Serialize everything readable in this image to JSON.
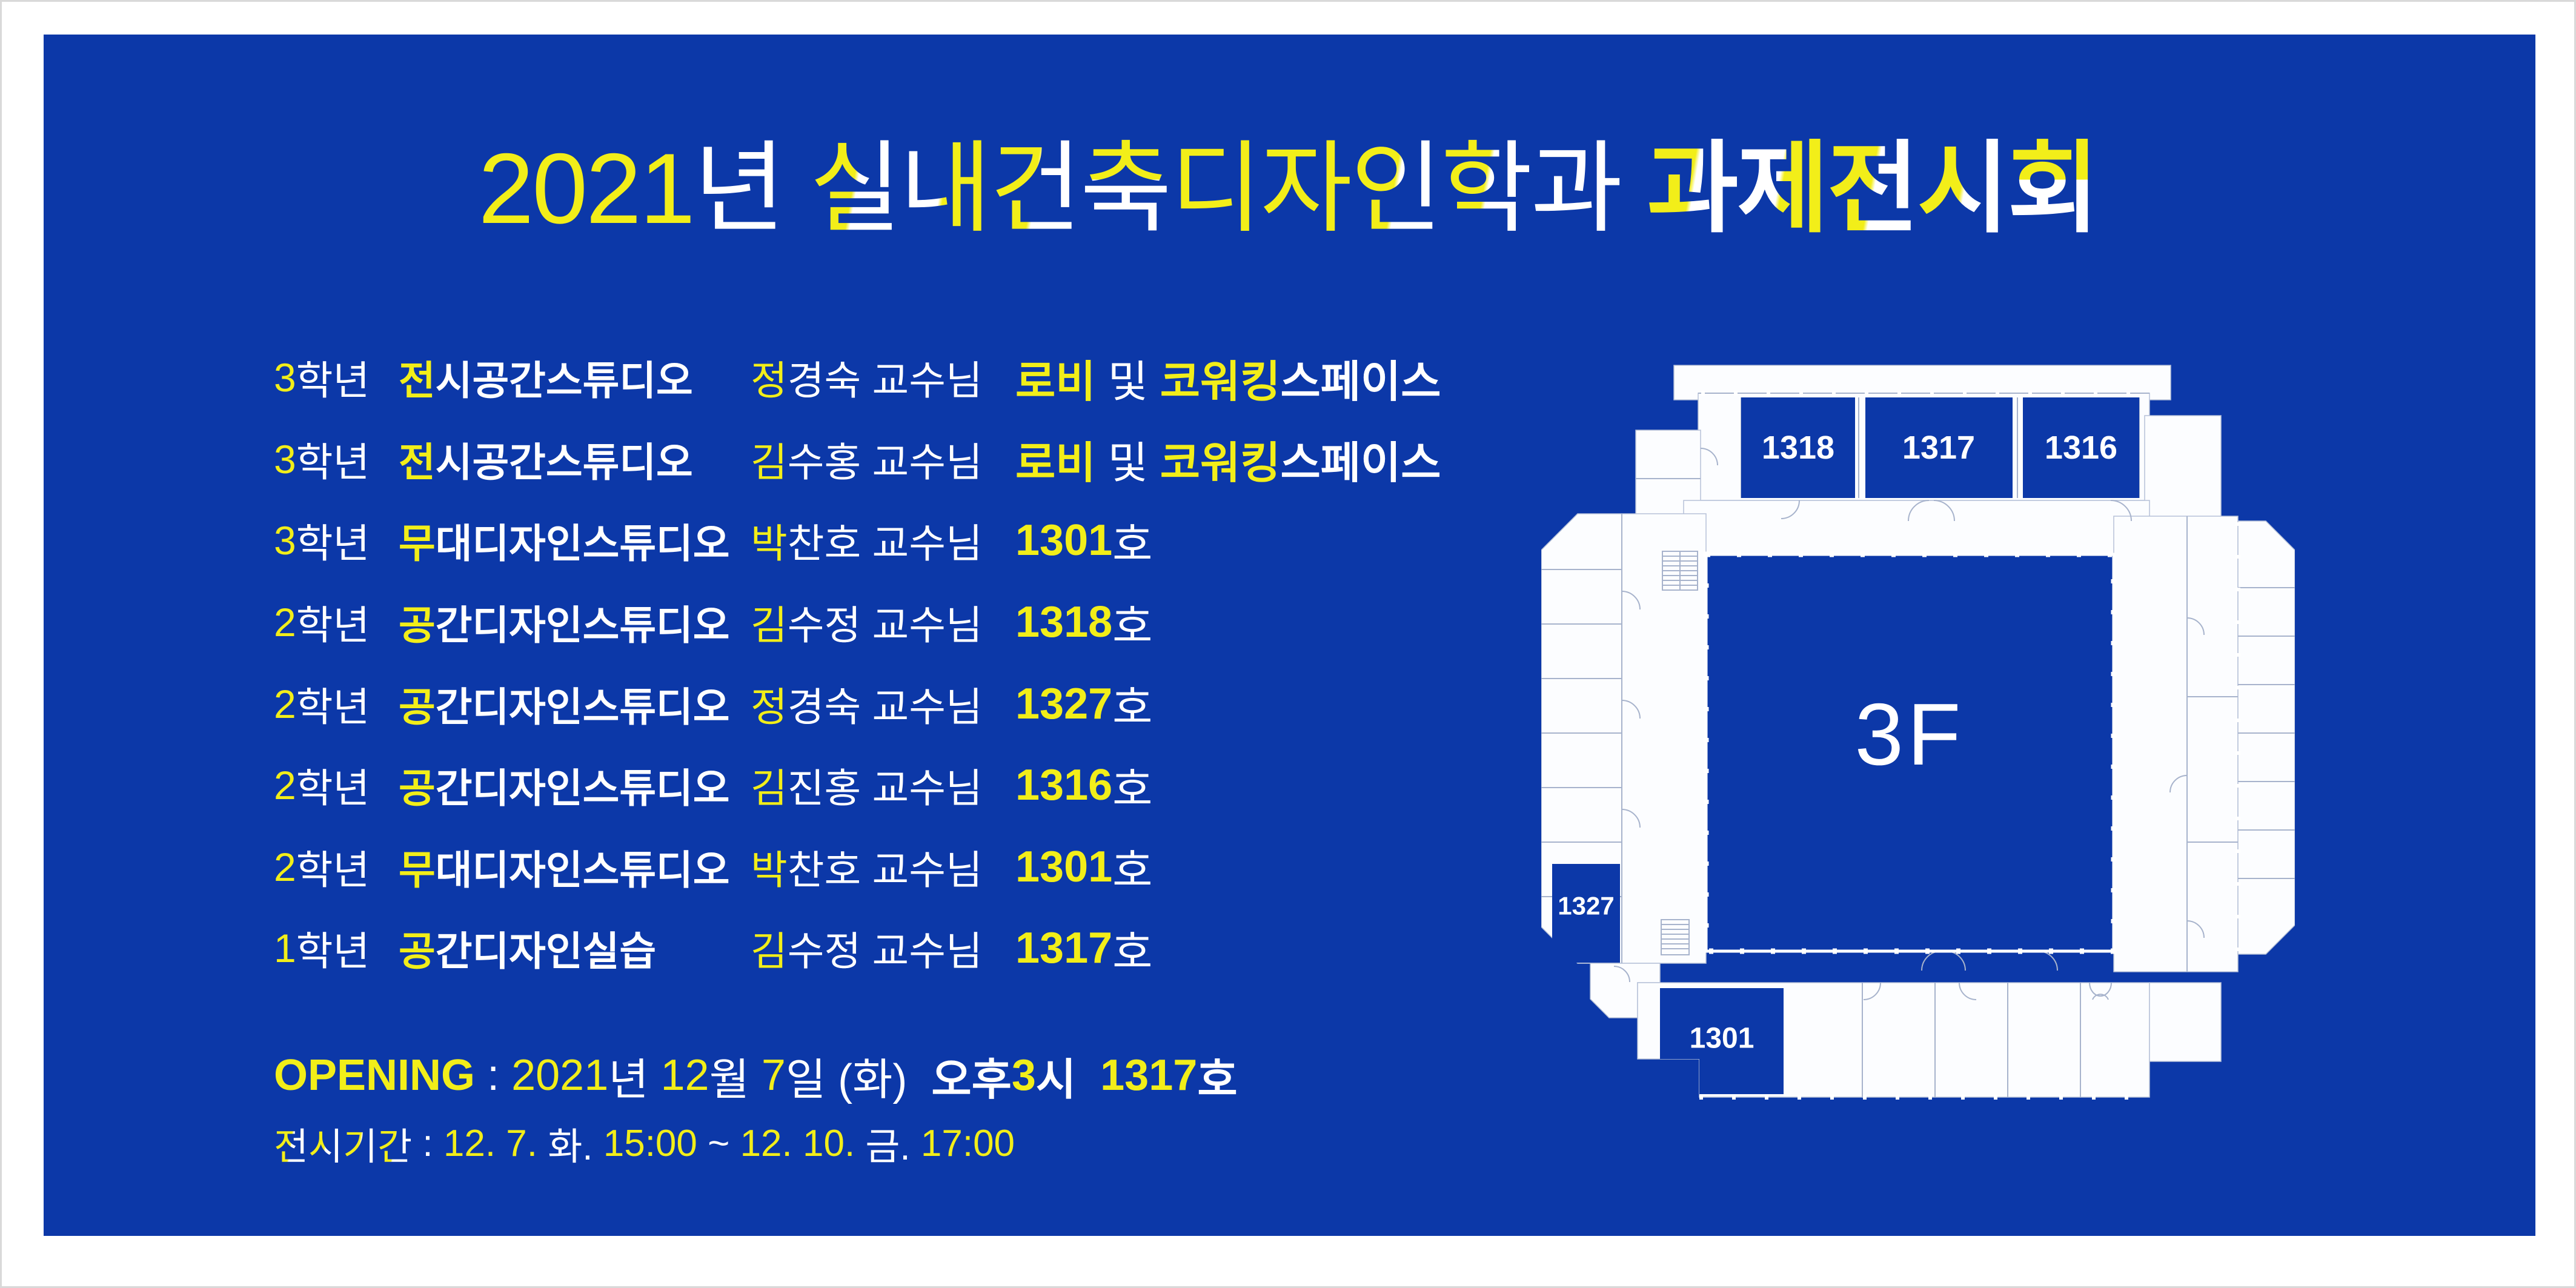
{
  "poster": {
    "colors": {
      "panel_blue": "#0C38A8",
      "accent_yellow": "#F2EE19",
      "text_white": "#FFFFFF",
      "plan_line": "#A7B3CC"
    },
    "title": {
      "segments": [
        {
          "t": "2021",
          "c": "y"
        },
        {
          "t": "년",
          "c": "w"
        },
        {
          "t": " ",
          "c": "w"
        },
        {
          "t": "실",
          "c": "yw"
        },
        {
          "t": "내",
          "c": "wy"
        },
        {
          "t": "건",
          "c": "yw"
        },
        {
          "t": "축",
          "c": "tb"
        },
        {
          "t": "디",
          "c": "y"
        },
        {
          "t": "자",
          "c": "y"
        },
        {
          "t": "인",
          "c": "yw"
        },
        {
          "t": "학",
          "c": "yw"
        },
        {
          "t": "과",
          "c": "w"
        },
        {
          "t": " ",
          "c": "w"
        },
        {
          "t": "과",
          "c": "yw",
          "b": true
        },
        {
          "t": "제",
          "c": "wy",
          "b": true
        },
        {
          "t": "전",
          "c": "yw",
          "b": true
        },
        {
          "t": "시",
          "c": "yw",
          "b": true
        },
        {
          "t": "회",
          "c": "tb",
          "b": true
        }
      ]
    },
    "schedule": {
      "rows": [
        {
          "grade": [
            {
              "t": "3",
              "c": "y"
            },
            {
              "t": "학년",
              "c": "w"
            }
          ],
          "studio": [
            {
              "t": "전",
              "c": "y",
              "b": true
            },
            {
              "t": "시공간스튜디오",
              "c": "w",
              "b": true
            }
          ],
          "professor": [
            {
              "t": "정",
              "c": "y"
            },
            {
              "t": "경숙 교수님",
              "c": "w"
            }
          ],
          "location": [
            {
              "t": "로비",
              "c": "y",
              "b": true
            },
            {
              "t": " 및 ",
              "c": "w"
            },
            {
              "t": "코워킹",
              "c": "y",
              "b": true
            },
            {
              "t": "스페이스",
              "c": "w",
              "b": true
            }
          ]
        },
        {
          "grade": [
            {
              "t": "3",
              "c": "y"
            },
            {
              "t": "학년",
              "c": "w"
            }
          ],
          "studio": [
            {
              "t": "전",
              "c": "y",
              "b": true
            },
            {
              "t": "시공간스튜디오",
              "c": "w",
              "b": true
            }
          ],
          "professor": [
            {
              "t": "김",
              "c": "y"
            },
            {
              "t": "수홍 교수님",
              "c": "w"
            }
          ],
          "location": [
            {
              "t": "로비",
              "c": "y",
              "b": true
            },
            {
              "t": " 및 ",
              "c": "w"
            },
            {
              "t": "코워킹",
              "c": "y",
              "b": true
            },
            {
              "t": "스페이스",
              "c": "w",
              "b": true
            }
          ]
        },
        {
          "grade": [
            {
              "t": "3",
              "c": "y"
            },
            {
              "t": "학년",
              "c": "w"
            }
          ],
          "studio": [
            {
              "t": "무",
              "c": "y",
              "b": true
            },
            {
              "t": "대디자인스튜디오",
              "c": "w",
              "b": true
            }
          ],
          "professor": [
            {
              "t": "박",
              "c": "y"
            },
            {
              "t": "찬호 교수님",
              "c": "w"
            }
          ],
          "location": [
            {
              "t": "1301",
              "c": "y",
              "b": true
            },
            {
              "t": "호",
              "c": "w"
            }
          ]
        },
        {
          "grade": [
            {
              "t": "2",
              "c": "y"
            },
            {
              "t": "학년",
              "c": "w"
            }
          ],
          "studio": [
            {
              "t": "공",
              "c": "y",
              "b": true
            },
            {
              "t": "간디자인스튜디오",
              "c": "w",
              "b": true
            }
          ],
          "professor": [
            {
              "t": "김",
              "c": "y"
            },
            {
              "t": "수정 교수님",
              "c": "w"
            }
          ],
          "location": [
            {
              "t": "1318",
              "c": "y",
              "b": true
            },
            {
              "t": "호",
              "c": "w"
            }
          ]
        },
        {
          "grade": [
            {
              "t": "2",
              "c": "y"
            },
            {
              "t": "학년",
              "c": "w"
            }
          ],
          "studio": [
            {
              "t": "공",
              "c": "y",
              "b": true
            },
            {
              "t": "간디자인스튜디오",
              "c": "w",
              "b": true
            }
          ],
          "professor": [
            {
              "t": "정",
              "c": "y"
            },
            {
              "t": "경숙 교수님",
              "c": "w"
            }
          ],
          "location": [
            {
              "t": "1327",
              "c": "y",
              "b": true
            },
            {
              "t": "호",
              "c": "w"
            }
          ]
        },
        {
          "grade": [
            {
              "t": "2",
              "c": "y"
            },
            {
              "t": "학년",
              "c": "w"
            }
          ],
          "studio": [
            {
              "t": "공",
              "c": "y",
              "b": true
            },
            {
              "t": "간디자인스튜디오",
              "c": "w",
              "b": true
            }
          ],
          "professor": [
            {
              "t": "김",
              "c": "y"
            },
            {
              "t": "진홍 교수님",
              "c": "w"
            }
          ],
          "location": [
            {
              "t": "1316",
              "c": "y",
              "b": true
            },
            {
              "t": "호",
              "c": "w"
            }
          ]
        },
        {
          "grade": [
            {
              "t": "2",
              "c": "y"
            },
            {
              "t": "학년",
              "c": "w"
            }
          ],
          "studio": [
            {
              "t": "무",
              "c": "y",
              "b": true
            },
            {
              "t": "대디자인스튜디오",
              "c": "w",
              "b": true
            }
          ],
          "professor": [
            {
              "t": "박",
              "c": "y"
            },
            {
              "t": "찬호 교수님",
              "c": "w"
            }
          ],
          "location": [
            {
              "t": "1301",
              "c": "y",
              "b": true
            },
            {
              "t": "호",
              "c": "w"
            }
          ]
        },
        {
          "grade": [
            {
              "t": "1",
              "c": "y"
            },
            {
              "t": "학년",
              "c": "w"
            }
          ],
          "studio": [
            {
              "t": "공",
              "c": "y",
              "b": true
            },
            {
              "t": "간디자인실습",
              "c": "w",
              "b": true
            }
          ],
          "professor": [
            {
              "t": "김",
              "c": "y"
            },
            {
              "t": "수정 교수님",
              "c": "w"
            }
          ],
          "location": [
            {
              "t": "1317",
              "c": "y",
              "b": true
            },
            {
              "t": "호",
              "c": "w"
            }
          ]
        }
      ]
    },
    "opening": {
      "segments": [
        {
          "t": "OPENING",
          "c": "y",
          "b": true
        },
        {
          "t": " : ",
          "c": "w"
        },
        {
          "t": "2021",
          "c": "y"
        },
        {
          "t": "년 ",
          "c": "w"
        },
        {
          "t": "12",
          "c": "y"
        },
        {
          "t": "월 ",
          "c": "w"
        },
        {
          "t": "7",
          "c": "y"
        },
        {
          "t": "일 (화)",
          "c": "w"
        },
        {
          "t": "  ",
          "c": "w"
        },
        {
          "t": "오후",
          "c": "w",
          "b": true
        },
        {
          "t": "3",
          "c": "y",
          "b": true
        },
        {
          "t": "시",
          "c": "w",
          "b": true
        },
        {
          "t": "  ",
          "c": "w"
        },
        {
          "t": "1317",
          "c": "y",
          "b": true
        },
        {
          "t": "호",
          "c": "w",
          "b": true
        }
      ]
    },
    "period": {
      "segments": [
        {
          "t": "전",
          "c": "yw"
        },
        {
          "t": "시",
          "c": "yw"
        },
        {
          "t": "기",
          "c": "yw"
        },
        {
          "t": "간",
          "c": "yw"
        },
        {
          "t": " : ",
          "c": "w"
        },
        {
          "t": "12. 7. ",
          "c": "y"
        },
        {
          "t": "화. ",
          "c": "w"
        },
        {
          "t": "15:00",
          "c": "y"
        },
        {
          "t": " ~ ",
          "c": "w"
        },
        {
          "t": "12. 10. ",
          "c": "y"
        },
        {
          "t": "금. ",
          "c": "w"
        },
        {
          "t": "17:00",
          "c": "y"
        }
      ]
    },
    "floorplan": {
      "level_label": "3F",
      "room_labels": {
        "r1318": "1318",
        "r1317": "1317",
        "r1316": "1316",
        "r1327": "1327",
        "r1301": "1301"
      }
    }
  }
}
